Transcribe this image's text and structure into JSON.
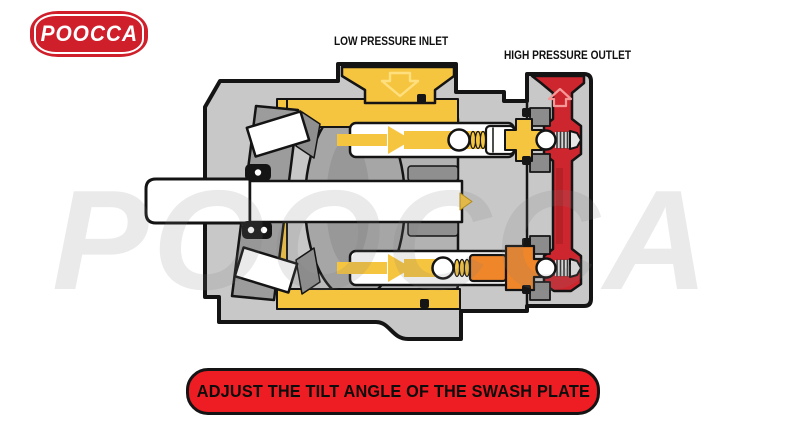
{
  "logo": {
    "text": "POOCCA"
  },
  "watermark": {
    "text": "POOCCA"
  },
  "labels": {
    "low_pressure_inlet": "LOW PRESSURE INLET",
    "high_pressure_outlet": "HIGH PRESSURE OUTLET"
  },
  "banner": {
    "text": "ADJUST THE TILT ANGLE OF THE SWASH PLATE"
  },
  "icons": {
    "inlet_flow_icon": "arrow-down",
    "outlet_flow_icon": "arrow-up"
  },
  "colors": {
    "low_pressure_yellow": "#f6c540",
    "inlet_arrow_light": "#ffdf7e",
    "high_pressure_red": "#ce262e",
    "high_pressure_dark": "#a81e24",
    "outlet_arrow_light": "#f49898",
    "transition_orange": "#f0862a",
    "housing_gray": "#c8c8c8",
    "block_gray": "#b2b2b2",
    "dark_gray": "#8f8f8f",
    "outline_black": "#141414",
    "banner_red": "#ee1c23",
    "logo_red": "#cf1f2b"
  }
}
